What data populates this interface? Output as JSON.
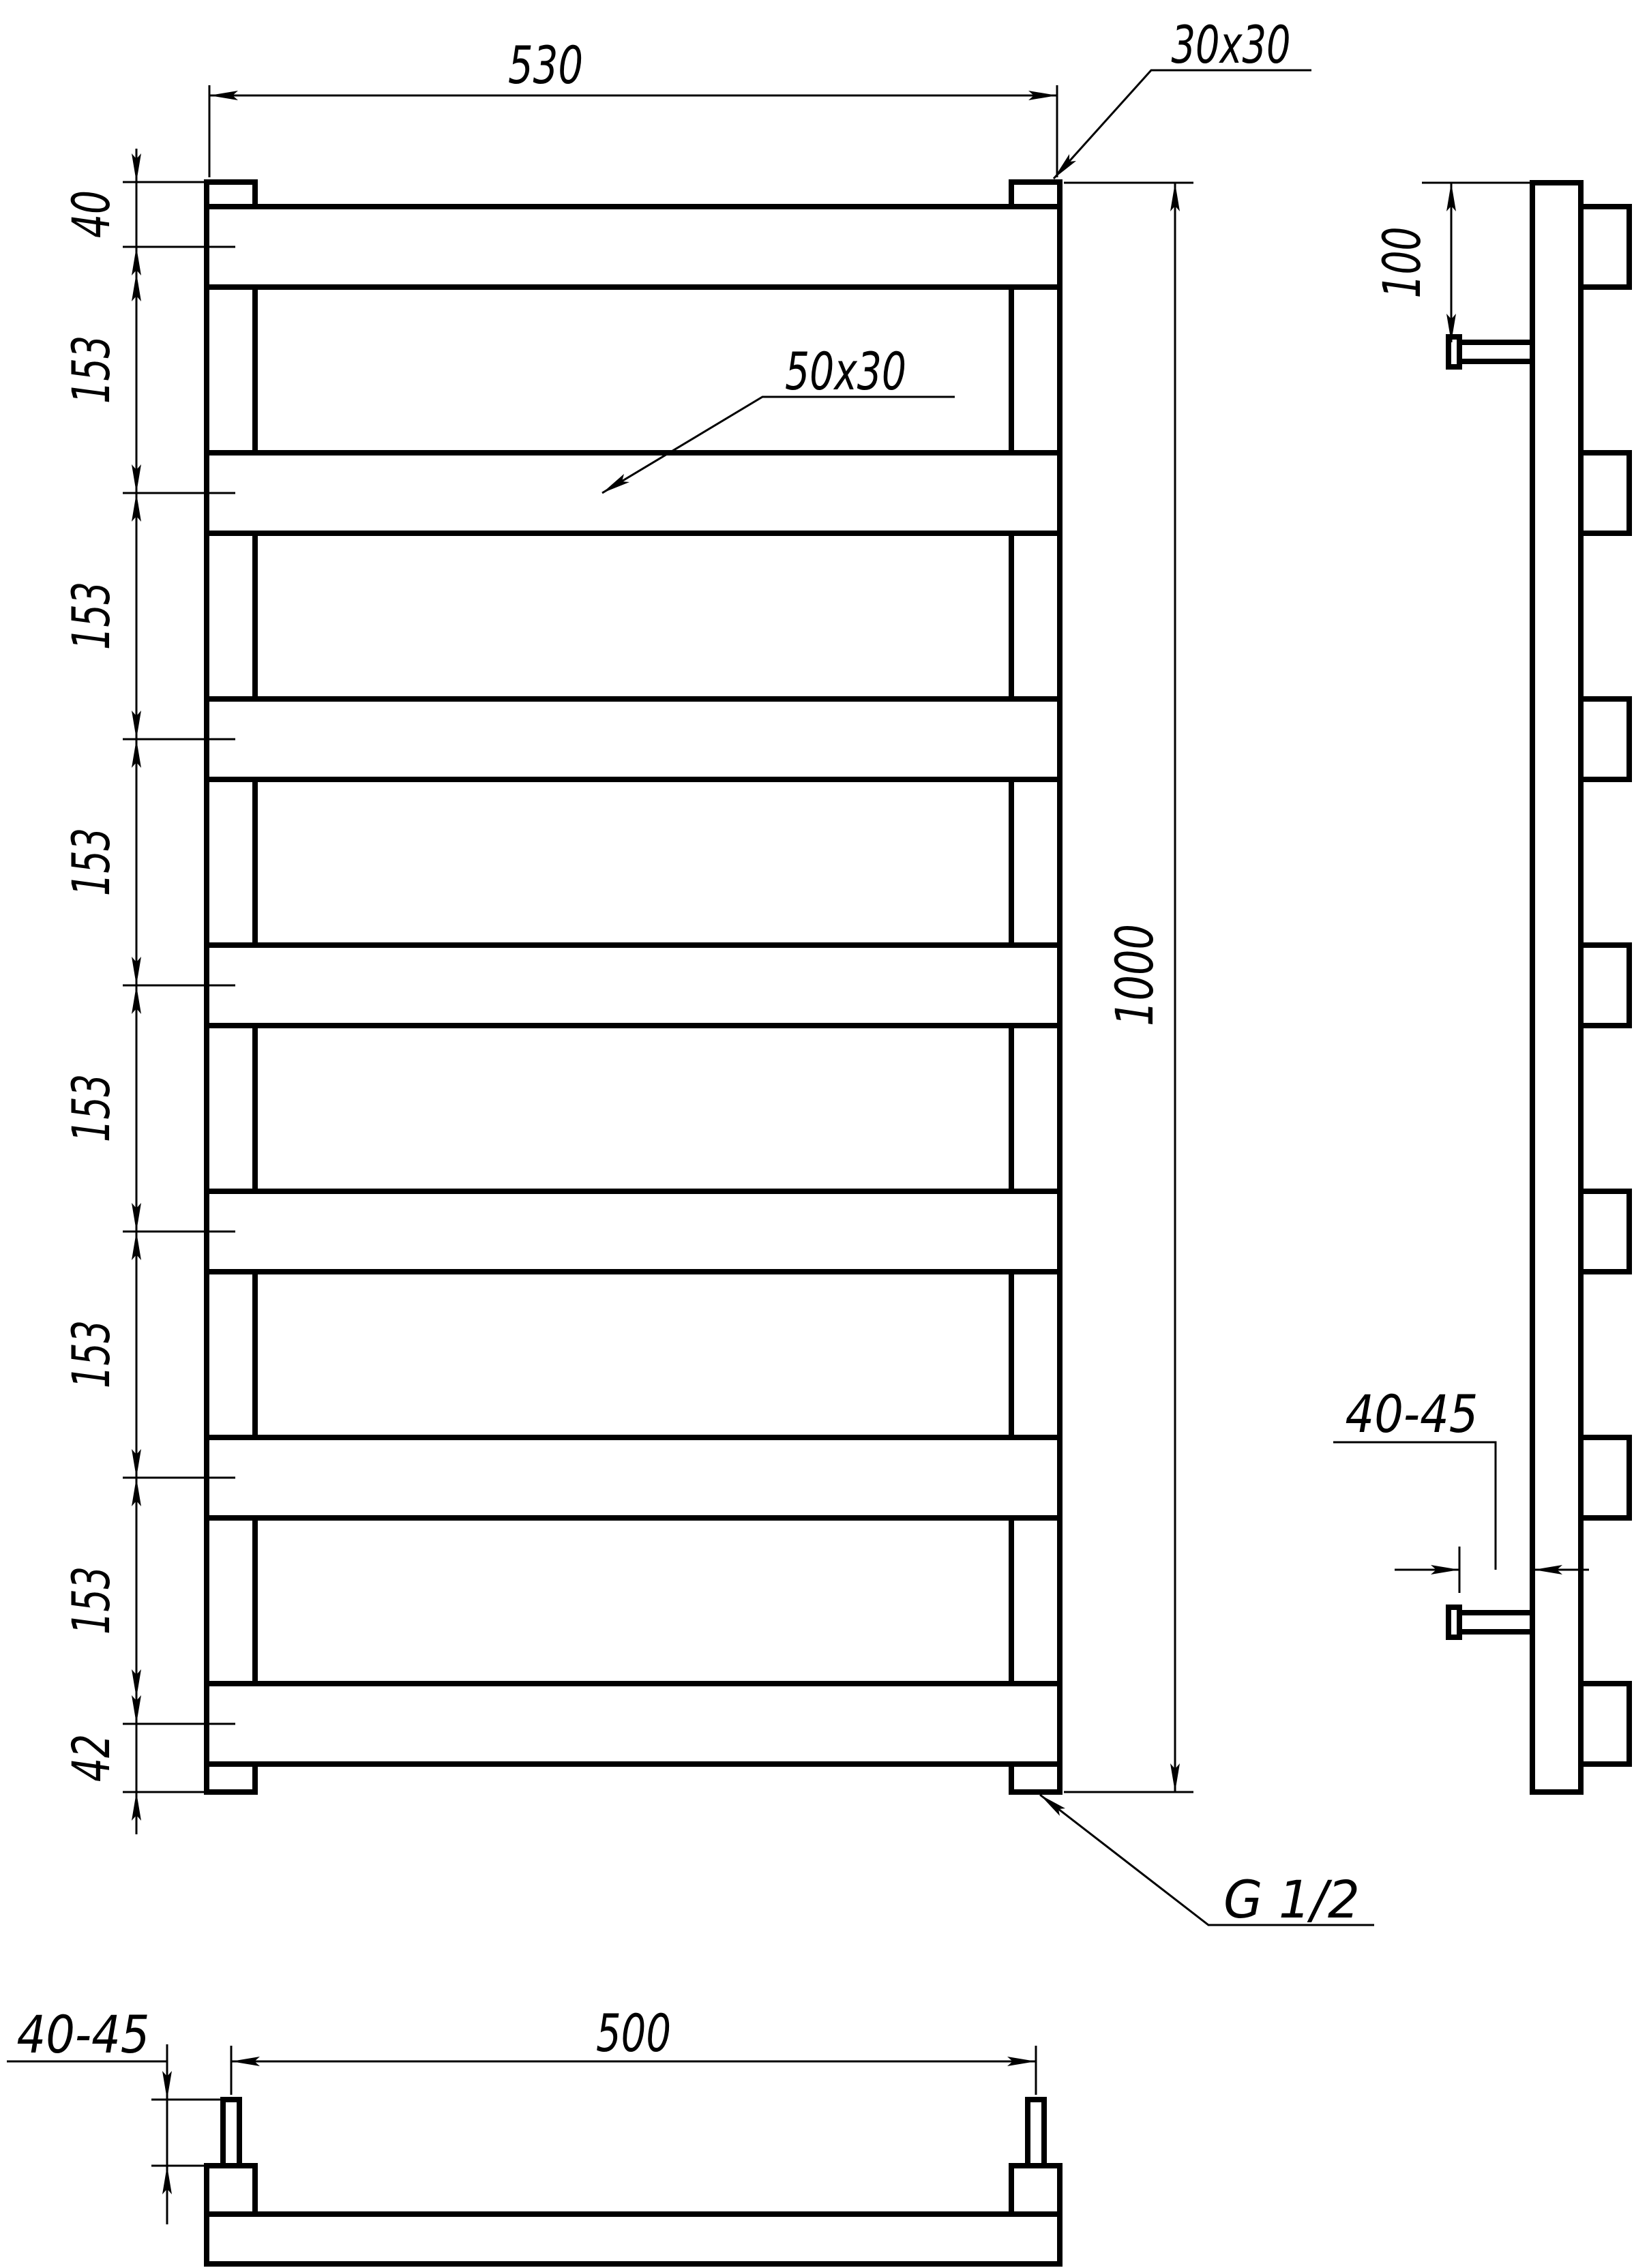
{
  "meta": {
    "ink_color": "#000000",
    "paper_color": "#ffffff"
  },
  "front_view": {
    "dim_width": "530",
    "dim_height": "1000",
    "post_profile": "30x30",
    "rung_profile": "50x30",
    "thread": "G 1/2",
    "chain": [
      "40",
      "153",
      "153",
      "153",
      "153",
      "153",
      "153",
      "42"
    ]
  },
  "side_view": {
    "dim_top_bracket_offset": "100",
    "dim_wall_offset": "40-45"
  },
  "bottom_view": {
    "dim_bracket_spacing": "500",
    "dim_wall_offset": "40-45"
  }
}
